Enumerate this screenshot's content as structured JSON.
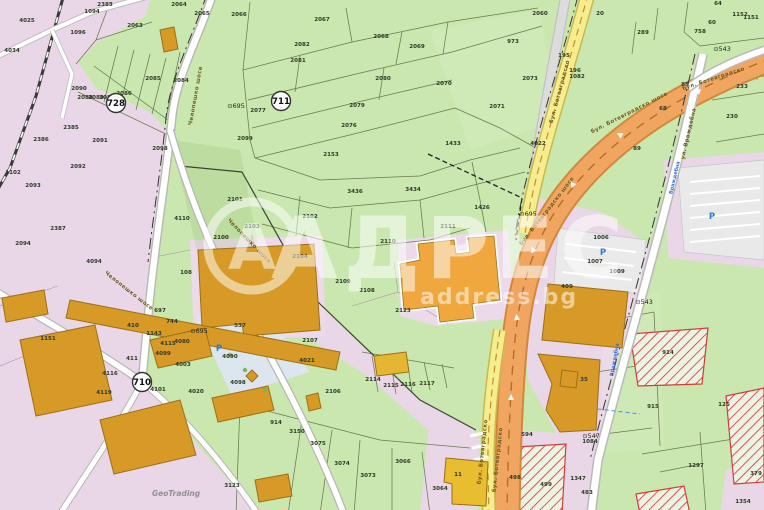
{
  "map": {
    "watermark": {
      "brand": "АДРЕС",
      "domain": "address.bg",
      "logo_letter": "А"
    },
    "attribution": {
      "text": "GeoTrading",
      "x": 152,
      "y": 496
    },
    "parking_symbol": "P",
    "parking_positions": [
      {
        "x": 219,
        "y": 351
      },
      {
        "x": 603,
        "y": 255
      },
      {
        "x": 712,
        "y": 219
      }
    ],
    "road_badges": [
      {
        "label": "728",
        "x": 116,
        "y": 103
      },
      {
        "label": "711",
        "x": 281,
        "y": 101
      },
      {
        "label": "710",
        "x": 142,
        "y": 382
      }
    ],
    "survey_markers": [
      {
        "label": "695",
        "x": 236,
        "y": 108
      },
      {
        "label": "695",
        "x": 528,
        "y": 216
      },
      {
        "label": "695",
        "x": 199,
        "y": 333
      },
      {
        "label": "543",
        "x": 644,
        "y": 304
      },
      {
        "label": "547",
        "x": 591,
        "y": 438
      },
      {
        "label": "543",
        "x": 722,
        "y": 51
      }
    ],
    "road_labels": [
      {
        "text": "бул. Ботевградско шосе",
        "x": 630,
        "y": 114,
        "rot": -27
      },
      {
        "text": "бул. Ботевградско шосе",
        "x": 548,
        "y": 212,
        "rot": -52
      },
      {
        "text": "бул. Ботевградско",
        "x": 714,
        "y": 80,
        "rot": -18
      },
      {
        "text": "бул. Ботевградско",
        "x": 561,
        "y": 92,
        "rot": -75
      },
      {
        "text": "бул. Ботевградско",
        "x": 484,
        "y": 452,
        "rot": -84
      },
      {
        "text": "бул. Ботевградско",
        "x": 499,
        "y": 460,
        "rot": -84
      },
      {
        "text": "Челопешко шосе",
        "x": 197,
        "y": 96,
        "rot": -80
      },
      {
        "text": "Челопешко шосе",
        "x": 248,
        "y": 242,
        "rot": 46
      },
      {
        "text": "Челопешко шосе",
        "x": 128,
        "y": 292,
        "rot": 38
      },
      {
        "text": "ул. Враждебна",
        "x": 690,
        "y": 134,
        "rot": -77
      }
    ],
    "blue_labels": [
      {
        "text": "Враждебна",
        "x": 676,
        "y": 178,
        "rot": -77
      },
      {
        "text": "Враждебна",
        "x": 616,
        "y": 360,
        "rot": -80
      }
    ],
    "parcels": [
      {
        "n": "2383",
        "x": 105,
        "y": 6
      },
      {
        "n": "2064",
        "x": 179,
        "y": 6
      },
      {
        "n": "2065",
        "x": 202,
        "y": 15
      },
      {
        "n": "2066",
        "x": 239,
        "y": 16
      },
      {
        "n": "2063",
        "x": 135,
        "y": 27
      },
      {
        "n": "1094",
        "x": 92,
        "y": 13
      },
      {
        "n": "4025",
        "x": 27,
        "y": 22
      },
      {
        "n": "1096",
        "x": 78,
        "y": 34
      },
      {
        "n": "4034",
        "x": 12,
        "y": 52
      },
      {
        "n": "2067",
        "x": 322,
        "y": 21
      },
      {
        "n": "2068",
        "x": 381,
        "y": 38
      },
      {
        "n": "2069",
        "x": 417,
        "y": 48
      },
      {
        "n": "2070",
        "x": 444,
        "y": 85
      },
      {
        "n": "2060",
        "x": 540,
        "y": 15
      },
      {
        "n": "20",
        "x": 600,
        "y": 15
      },
      {
        "n": "289",
        "x": 643,
        "y": 34
      },
      {
        "n": "64",
        "x": 718,
        "y": 5
      },
      {
        "n": "60",
        "x": 712,
        "y": 24
      },
      {
        "n": "758",
        "x": 700,
        "y": 33
      },
      {
        "n": "1152",
        "x": 740,
        "y": 16
      },
      {
        "n": "1151",
        "x": 751,
        "y": 19
      },
      {
        "n": "973",
        "x": 513,
        "y": 43
      },
      {
        "n": "2073",
        "x": 530,
        "y": 80
      },
      {
        "n": "195",
        "x": 564,
        "y": 57
      },
      {
        "n": "196",
        "x": 575,
        "y": 72
      },
      {
        "n": "85",
        "x": 685,
        "y": 86
      },
      {
        "n": "68",
        "x": 663,
        "y": 110
      },
      {
        "n": "89",
        "x": 637,
        "y": 150
      },
      {
        "n": "230",
        "x": 732,
        "y": 118
      },
      {
        "n": "233",
        "x": 742,
        "y": 88
      },
      {
        "n": "2082",
        "x": 302,
        "y": 46
      },
      {
        "n": "2081",
        "x": 298,
        "y": 62
      },
      {
        "n": "2080",
        "x": 383,
        "y": 80
      },
      {
        "n": "2079",
        "x": 357,
        "y": 107
      },
      {
        "n": "2077",
        "x": 258,
        "y": 112
      },
      {
        "n": "2076",
        "x": 349,
        "y": 127
      },
      {
        "n": "2071",
        "x": 497,
        "y": 108
      },
      {
        "n": "1433",
        "x": 453,
        "y": 145
      },
      {
        "n": "2153",
        "x": 331,
        "y": 156
      },
      {
        "n": "2085",
        "x": 153,
        "y": 80
      },
      {
        "n": "2084",
        "x": 181,
        "y": 82
      },
      {
        "n": "2090",
        "x": 79,
        "y": 90
      },
      {
        "n": "2088",
        "x": 85,
        "y": 99
      },
      {
        "n": "2089",
        "x": 96,
        "y": 99
      },
      {
        "n": "2087",
        "x": 107,
        "y": 99
      },
      {
        "n": "2086",
        "x": 124,
        "y": 95
      },
      {
        "n": "2385",
        "x": 71,
        "y": 129
      },
      {
        "n": "2386",
        "x": 41,
        "y": 141
      },
      {
        "n": "2091",
        "x": 100,
        "y": 142
      },
      {
        "n": "2092",
        "x": 78,
        "y": 168
      },
      {
        "n": "2098",
        "x": 160,
        "y": 150
      },
      {
        "n": "2099",
        "x": 245,
        "y": 140
      },
      {
        "n": "2093",
        "x": 33,
        "y": 187
      },
      {
        "n": "1102",
        "x": 13,
        "y": 174
      },
      {
        "n": "2094",
        "x": 23,
        "y": 245
      },
      {
        "n": "2387",
        "x": 58,
        "y": 230
      },
      {
        "n": "4110",
        "x": 182,
        "y": 220
      },
      {
        "n": "108",
        "x": 186,
        "y": 274
      },
      {
        "n": "4094",
        "x": 94,
        "y": 263
      },
      {
        "n": "2101",
        "x": 235,
        "y": 201
      },
      {
        "n": "2103",
        "x": 252,
        "y": 228
      },
      {
        "n": "2100",
        "x": 221,
        "y": 239
      },
      {
        "n": "2102",
        "x": 310,
        "y": 218
      },
      {
        "n": "3436",
        "x": 355,
        "y": 193
      },
      {
        "n": "3434",
        "x": 413,
        "y": 191
      },
      {
        "n": "2110",
        "x": 388,
        "y": 243
      },
      {
        "n": "2104",
        "x": 300,
        "y": 258
      },
      {
        "n": "2109",
        "x": 343,
        "y": 283
      },
      {
        "n": "2108",
        "x": 367,
        "y": 292
      },
      {
        "n": "2111",
        "x": 448,
        "y": 228
      },
      {
        "n": "1426",
        "x": 482,
        "y": 209
      },
      {
        "n": "2123",
        "x": 403,
        "y": 312
      },
      {
        "n": "537",
        "x": 240,
        "y": 327
      },
      {
        "n": "2107",
        "x": 310,
        "y": 342
      },
      {
        "n": "2106",
        "x": 333,
        "y": 393
      },
      {
        "n": "2114",
        "x": 373,
        "y": 381
      },
      {
        "n": "2115",
        "x": 391,
        "y": 387
      },
      {
        "n": "2116",
        "x": 408,
        "y": 386
      },
      {
        "n": "2117",
        "x": 427,
        "y": 385
      },
      {
        "n": "3150",
        "x": 297,
        "y": 433
      },
      {
        "n": "914",
        "x": 276,
        "y": 424
      },
      {
        "n": "3075",
        "x": 318,
        "y": 445
      },
      {
        "n": "3074",
        "x": 342,
        "y": 465
      },
      {
        "n": "3073",
        "x": 368,
        "y": 477
      },
      {
        "n": "3066",
        "x": 403,
        "y": 463
      },
      {
        "n": "3064",
        "x": 440,
        "y": 490
      },
      {
        "n": "3123",
        "x": 232,
        "y": 487
      },
      {
        "n": "11",
        "x": 458,
        "y": 476
      },
      {
        "n": "4022",
        "x": 538,
        "y": 145
      },
      {
        "n": "1082",
        "x": 577,
        "y": 78
      },
      {
        "n": "697",
        "x": 160,
        "y": 312
      },
      {
        "n": "744",
        "x": 172,
        "y": 323
      },
      {
        "n": "410",
        "x": 133,
        "y": 327
      },
      {
        "n": "1143",
        "x": 154,
        "y": 335
      },
      {
        "n": "1151",
        "x": 48,
        "y": 340
      },
      {
        "n": "4115",
        "x": 168,
        "y": 345
      },
      {
        "n": "4099",
        "x": 163,
        "y": 355
      },
      {
        "n": "4080",
        "x": 182,
        "y": 343
      },
      {
        "n": "411",
        "x": 132,
        "y": 360
      },
      {
        "n": "4003",
        "x": 183,
        "y": 366
      },
      {
        "n": "4101",
        "x": 158,
        "y": 391
      },
      {
        "n": "4020",
        "x": 196,
        "y": 393
      },
      {
        "n": "4119",
        "x": 104,
        "y": 394
      },
      {
        "n": "4116",
        "x": 110,
        "y": 375
      },
      {
        "n": "4098",
        "x": 238,
        "y": 384
      },
      {
        "n": "4090",
        "x": 230,
        "y": 358
      },
      {
        "n": "4021",
        "x": 307,
        "y": 362
      },
      {
        "n": "915",
        "x": 653,
        "y": 408
      },
      {
        "n": "125",
        "x": 724,
        "y": 406
      },
      {
        "n": "914",
        "x": 668,
        "y": 354
      },
      {
        "n": "498",
        "x": 515,
        "y": 479
      },
      {
        "n": "499",
        "x": 546,
        "y": 486
      },
      {
        "n": "1347",
        "x": 578,
        "y": 480
      },
      {
        "n": "483",
        "x": 587,
        "y": 494
      },
      {
        "n": "1297",
        "x": 696,
        "y": 467
      },
      {
        "n": "379",
        "x": 756,
        "y": 475
      },
      {
        "n": "1354",
        "x": 743,
        "y": 503
      },
      {
        "n": "1084",
        "x": 590,
        "y": 443
      },
      {
        "n": "594",
        "x": 527,
        "y": 436
      },
      {
        "n": "35",
        "x": 584,
        "y": 381
      },
      {
        "n": "1006",
        "x": 601,
        "y": 239
      },
      {
        "n": "1007",
        "x": 595,
        "y": 263
      },
      {
        "n": "1009",
        "x": 617,
        "y": 273
      },
      {
        "n": "409",
        "x": 567,
        "y": 288
      }
    ]
  }
}
